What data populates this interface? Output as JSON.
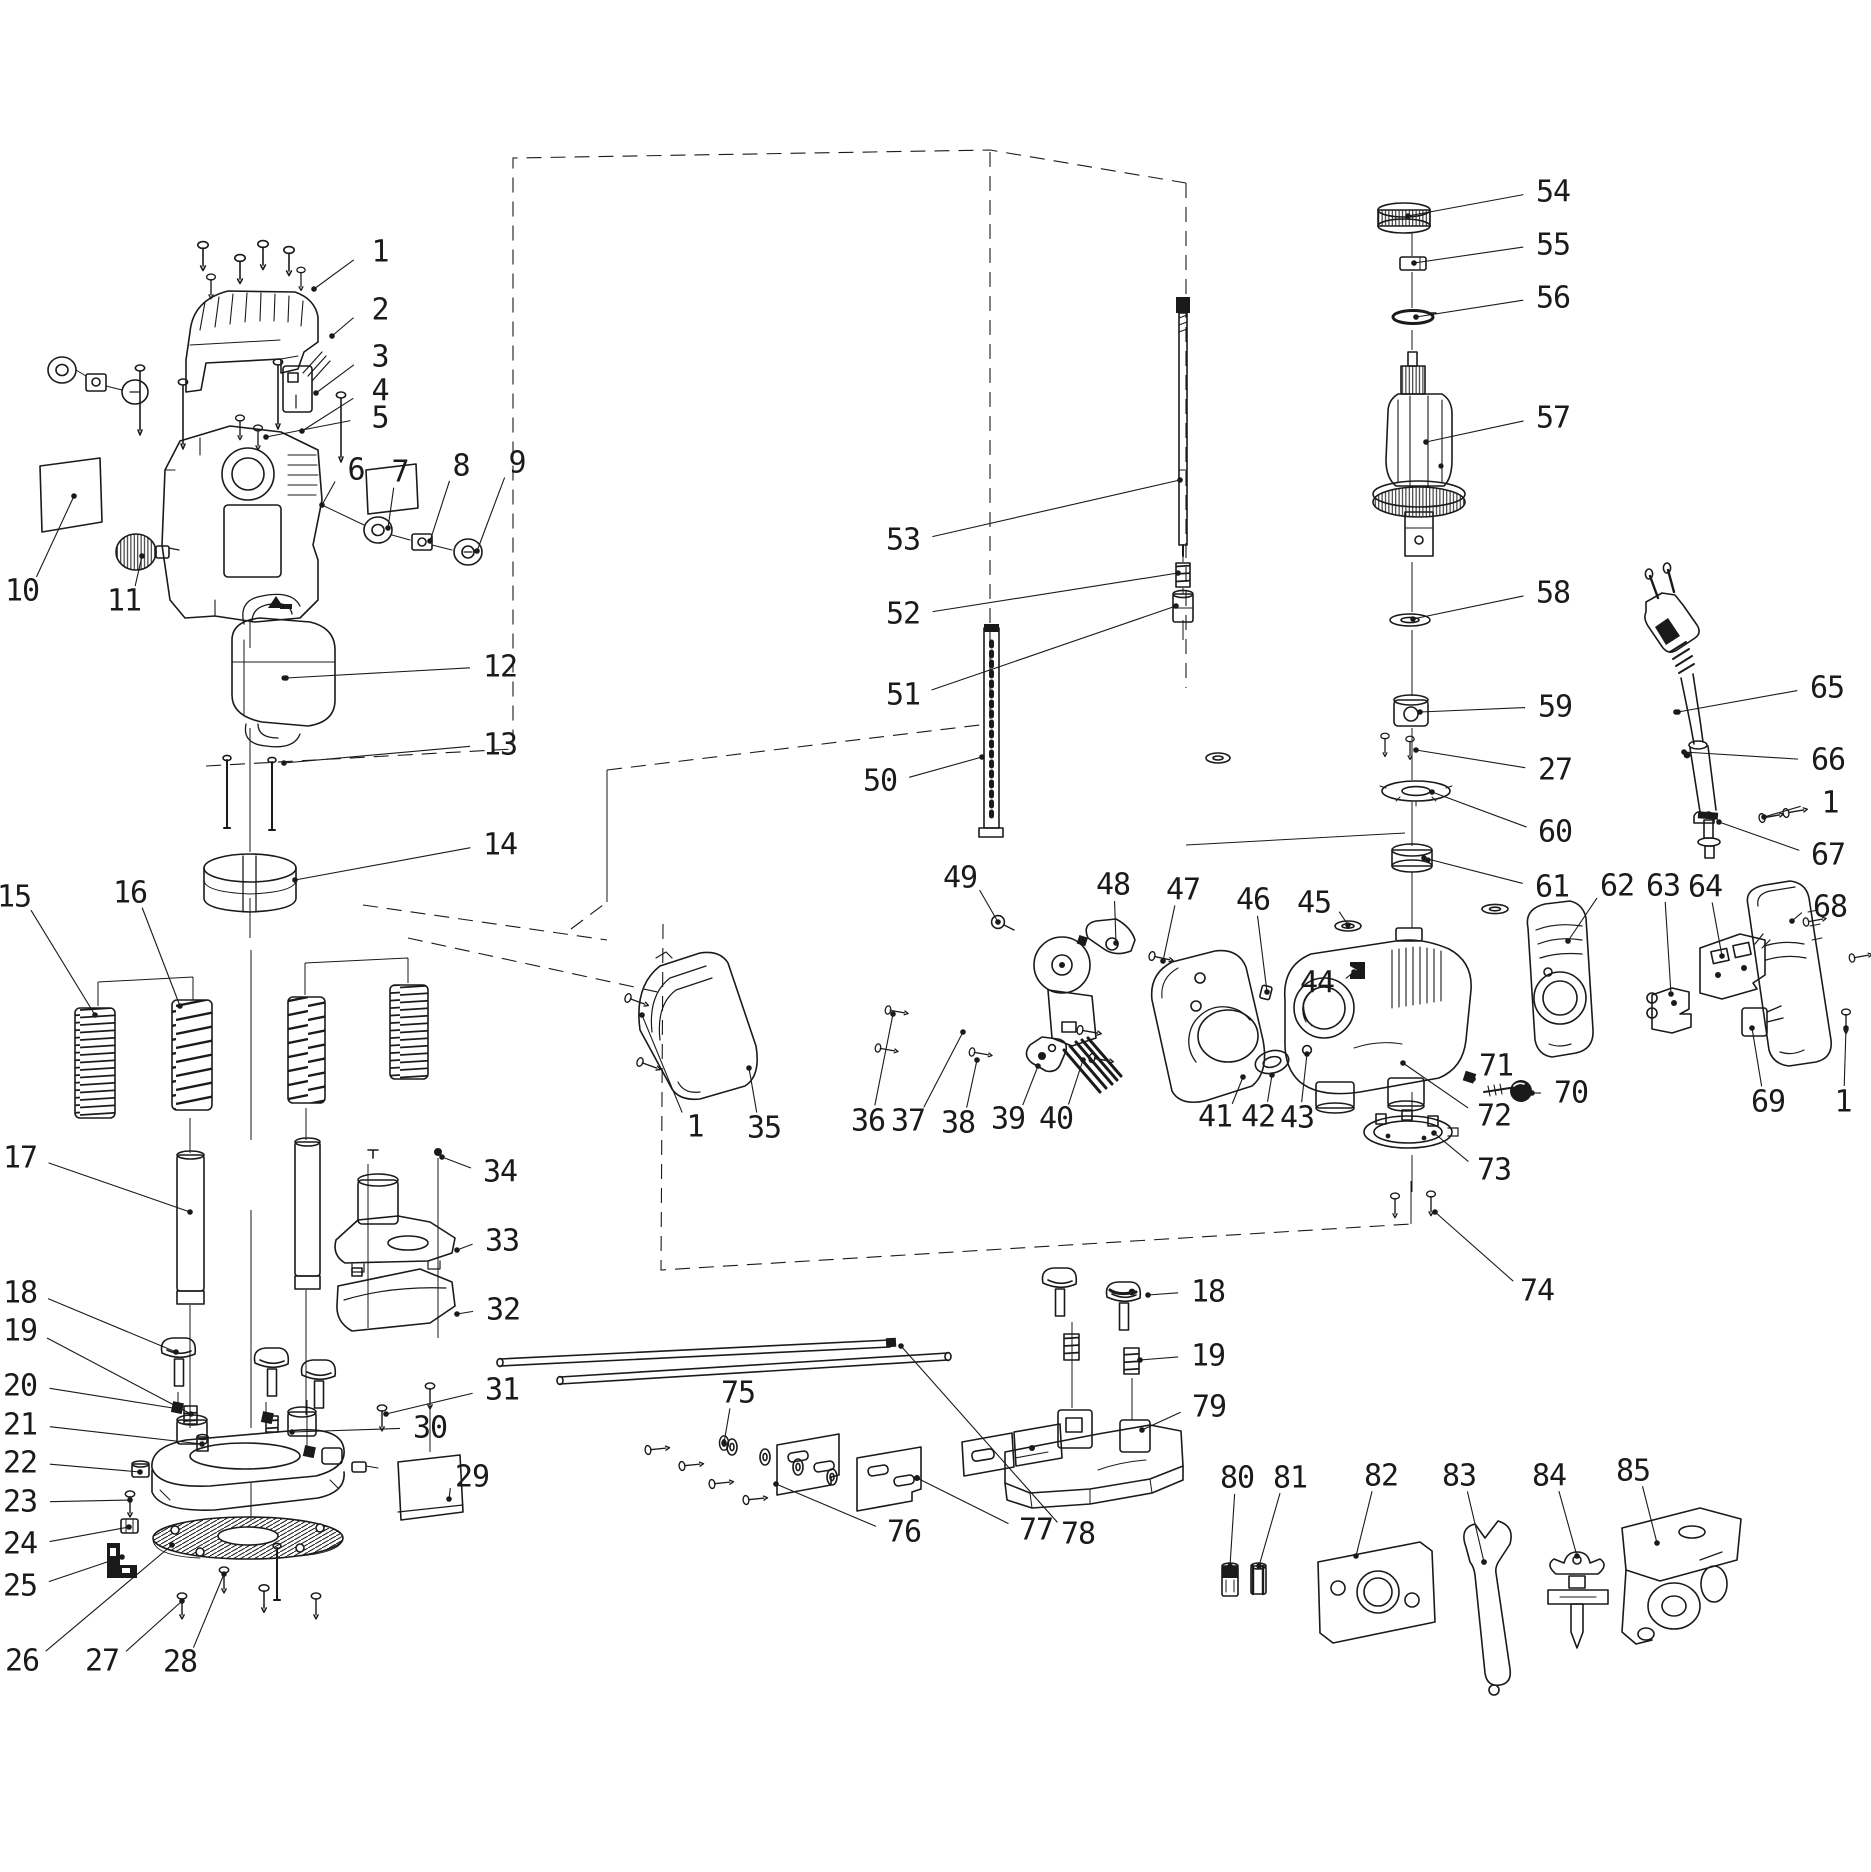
{
  "figure": {
    "width": 1871,
    "height": 1872,
    "background": "#ffffff",
    "ink": "#1a1a1a",
    "kind": "exploded-parts-diagram"
  },
  "callouts": [
    {
      "n": "1",
      "x": 380,
      "y": 252,
      "ex": 314,
      "ey": 289
    },
    {
      "n": "2",
      "x": 380,
      "y": 310,
      "ex": 332,
      "ey": 336
    },
    {
      "n": "3",
      "x": 380,
      "y": 357,
      "ex": 316,
      "ey": 393
    },
    {
      "n": "4",
      "x": 380,
      "y": 391,
      "ex": 302,
      "ey": 431
    },
    {
      "n": "5",
      "x": 380,
      "y": 418,
      "ex": 266,
      "ey": 437
    },
    {
      "n": "6",
      "x": 356,
      "y": 470,
      "ex": 322,
      "ey": 505
    },
    {
      "n": "7",
      "x": 400,
      "y": 472,
      "ex": 388,
      "ey": 528
    },
    {
      "n": "8",
      "x": 461,
      "y": 466,
      "ex": 430,
      "ey": 541
    },
    {
      "n": "9",
      "x": 517,
      "y": 463,
      "ex": 477,
      "ey": 551
    },
    {
      "n": "10",
      "x": 22,
      "y": 591,
      "ex": 74,
      "ey": 496
    },
    {
      "n": "11",
      "x": 124,
      "y": 601,
      "ex": 142,
      "ey": 556
    },
    {
      "n": "12",
      "x": 500,
      "y": 667,
      "ex": 286,
      "ey": 678
    },
    {
      "n": "13",
      "x": 500,
      "y": 745,
      "ex": 284,
      "ey": 763
    },
    {
      "n": "14",
      "x": 500,
      "y": 845,
      "ex": 295,
      "ey": 880
    },
    {
      "n": "15",
      "x": 14,
      "y": 897,
      "ex": 95,
      "ey": 1015
    },
    {
      "n": "16",
      "x": 130,
      "y": 893,
      "ex": 180,
      "ey": 1006
    },
    {
      "n": "17",
      "x": 20,
      "y": 1158,
      "ex": 190,
      "ey": 1212
    },
    {
      "n": "18",
      "x": 20,
      "y": 1293,
      "ex": 176,
      "ey": 1352
    },
    {
      "n": "19",
      "x": 20,
      "y": 1331,
      "ex": 191,
      "ey": 1414
    },
    {
      "n": "20",
      "x": 20,
      "y": 1386,
      "ex": 179,
      "ey": 1409
    },
    {
      "n": "21",
      "x": 20,
      "y": 1425,
      "ex": 202,
      "ey": 1444
    },
    {
      "n": "22",
      "x": 20,
      "y": 1463,
      "ex": 140,
      "ey": 1472
    },
    {
      "n": "23",
      "x": 20,
      "y": 1502,
      "ex": 130,
      "ey": 1500
    },
    {
      "n": "24",
      "x": 20,
      "y": 1544,
      "ex": 129,
      "ey": 1527
    },
    {
      "n": "25",
      "x": 20,
      "y": 1586,
      "ex": 122,
      "ey": 1557
    },
    {
      "n": "26",
      "x": 22,
      "y": 1661,
      "ex": 172,
      "ey": 1545
    },
    {
      "n": "27",
      "x": 102,
      "y": 1661,
      "ex": 182,
      "ey": 1601
    },
    {
      "n": "28",
      "x": 180,
      "y": 1662,
      "ex": 224,
      "ey": 1574
    },
    {
      "n": "29",
      "x": 472,
      "y": 1477,
      "ex": 449,
      "ey": 1499
    },
    {
      "n": "30",
      "x": 430,
      "y": 1428,
      "ex": 292,
      "ey": 1432
    },
    {
      "n": "31",
      "x": 502,
      "y": 1390,
      "ex": 386,
      "ey": 1414
    },
    {
      "n": "32",
      "x": 503,
      "y": 1310,
      "ex": 457,
      "ey": 1314
    },
    {
      "n": "33",
      "x": 502,
      "y": 1241,
      "ex": 457,
      "ey": 1250
    },
    {
      "n": "34",
      "x": 500,
      "y": 1172,
      "ex": 442,
      "ey": 1157
    },
    {
      "n": "1",
      "x": 695,
      "y": 1127,
      "ex": 642,
      "ey": 1015
    },
    {
      "n": "35",
      "x": 764,
      "y": 1128,
      "ex": 749,
      "ey": 1068
    },
    {
      "n": "36",
      "x": 868,
      "y": 1121,
      "ex": 893,
      "ey": 1014
    },
    {
      "n": "37",
      "x": 908,
      "y": 1121,
      "ex": 963,
      "ey": 1032
    },
    {
      "n": "38",
      "x": 958,
      "y": 1123,
      "ex": 977,
      "ey": 1060
    },
    {
      "n": "39",
      "x": 1008,
      "y": 1119,
      "ex": 1038,
      "ey": 1066
    },
    {
      "n": "40",
      "x": 1056,
      "y": 1119,
      "ex": 1083,
      "ey": 1060
    },
    {
      "n": "41",
      "x": 1215,
      "y": 1117,
      "ex": 1243,
      "ey": 1077
    },
    {
      "n": "42",
      "x": 1258,
      "y": 1117,
      "ex": 1272,
      "ey": 1075
    },
    {
      "n": "43",
      "x": 1297,
      "y": 1118,
      "ex": 1307,
      "ey": 1054
    },
    {
      "n": "44",
      "x": 1317,
      "y": 983,
      "ex": 1354,
      "ey": 972
    },
    {
      "n": "45",
      "x": 1314,
      "y": 903,
      "ex": 1348,
      "ey": 925
    },
    {
      "n": "46",
      "x": 1253,
      "y": 900,
      "ex": 1267,
      "ey": 992
    },
    {
      "n": "47",
      "x": 1183,
      "y": 890,
      "ex": 1163,
      "ey": 961
    },
    {
      "n": "48",
      "x": 1113,
      "y": 885,
      "ex": 1116,
      "ey": 943
    },
    {
      "n": "49",
      "x": 960,
      "y": 878,
      "ex": 998,
      "ey": 922
    },
    {
      "n": "50",
      "x": 880,
      "y": 781,
      "ex": 982,
      "ey": 757
    },
    {
      "n": "51",
      "x": 903,
      "y": 695,
      "ex": 1176,
      "ey": 606
    },
    {
      "n": "52",
      "x": 903,
      "y": 614,
      "ex": 1178,
      "ey": 573
    },
    {
      "n": "53",
      "x": 903,
      "y": 540,
      "ex": 1180,
      "ey": 480
    },
    {
      "n": "54",
      "x": 1553,
      "y": 192,
      "ex": 1408,
      "ey": 216
    },
    {
      "n": "55",
      "x": 1553,
      "y": 245,
      "ex": 1414,
      "ey": 263
    },
    {
      "n": "56",
      "x": 1553,
      "y": 298,
      "ex": 1416,
      "ey": 317
    },
    {
      "n": "57",
      "x": 1553,
      "y": 418,
      "ex": 1426,
      "ey": 442
    },
    {
      "n": "58",
      "x": 1553,
      "y": 593,
      "ex": 1413,
      "ey": 619
    },
    {
      "n": "59",
      "x": 1555,
      "y": 707,
      "ex": 1420,
      "ey": 712
    },
    {
      "n": "27",
      "x": 1555,
      "y": 770,
      "ex": 1416,
      "ey": 750
    },
    {
      "n": "60",
      "x": 1555,
      "y": 832,
      "ex": 1432,
      "ey": 792
    },
    {
      "n": "61",
      "x": 1552,
      "y": 887,
      "ex": 1424,
      "ey": 858
    },
    {
      "n": "62",
      "x": 1617,
      "y": 886,
      "ex": 1568,
      "ey": 941
    },
    {
      "n": "63",
      "x": 1663,
      "y": 886,
      "ex": 1671,
      "ey": 994
    },
    {
      "n": "64",
      "x": 1705,
      "y": 887,
      "ex": 1722,
      "ey": 956
    },
    {
      "n": "65",
      "x": 1827,
      "y": 688,
      "ex": 1678,
      "ey": 712
    },
    {
      "n": "66",
      "x": 1828,
      "y": 760,
      "ex": 1684,
      "ey": 752
    },
    {
      "n": "1",
      "x": 1830,
      "y": 803,
      "ex": 1764,
      "ey": 817
    },
    {
      "n": "67",
      "x": 1828,
      "y": 855,
      "ex": 1719,
      "ey": 822
    },
    {
      "n": "68",
      "x": 1830,
      "y": 907,
      "ex": 1792,
      "ey": 921
    },
    {
      "n": "69",
      "x": 1768,
      "y": 1102,
      "ex": 1752,
      "ey": 1028
    },
    {
      "n": "1",
      "x": 1843,
      "y": 1102,
      "ex": 1846,
      "ey": 1028
    },
    {
      "n": "70",
      "x": 1571,
      "y": 1093,
      "ex": 1532,
      "ey": 1093
    },
    {
      "n": "71",
      "x": 1496,
      "y": 1066,
      "ex": 1473,
      "ey": 1079
    },
    {
      "n": "72",
      "x": 1494,
      "y": 1116,
      "ex": 1403,
      "ey": 1063
    },
    {
      "n": "73",
      "x": 1494,
      "y": 1170,
      "ex": 1434,
      "ey": 1133
    },
    {
      "n": "74",
      "x": 1537,
      "y": 1291,
      "ex": 1435,
      "ey": 1212
    },
    {
      "n": "18",
      "x": 1208,
      "y": 1292,
      "ex": 1148,
      "ey": 1295
    },
    {
      "n": "19",
      "x": 1208,
      "y": 1356,
      "ex": 1140,
      "ey": 1360
    },
    {
      "n": "79",
      "x": 1209,
      "y": 1407,
      "ex": 1142,
      "ey": 1430
    },
    {
      "n": "75",
      "x": 738,
      "y": 1393,
      "ex": 724,
      "ey": 1443
    },
    {
      "n": "76",
      "x": 904,
      "y": 1532,
      "ex": 776,
      "ey": 1484
    },
    {
      "n": "77",
      "x": 1036,
      "y": 1530,
      "ex": 917,
      "ey": 1478
    },
    {
      "n": "78",
      "x": 1078,
      "y": 1534,
      "ex": 901,
      "ey": 1346
    },
    {
      "n": "80",
      "x": 1237,
      "y": 1478,
      "ex": 1230,
      "ey": 1566
    },
    {
      "n": "81",
      "x": 1290,
      "y": 1478,
      "ex": 1259,
      "ey": 1566
    },
    {
      "n": "82",
      "x": 1381,
      "y": 1476,
      "ex": 1356,
      "ey": 1556
    },
    {
      "n": "83",
      "x": 1459,
      "y": 1476,
      "ex": 1484,
      "ey": 1562
    },
    {
      "n": "84",
      "x": 1549,
      "y": 1476,
      "ex": 1577,
      "ey": 1556
    },
    {
      "n": "85",
      "x": 1633,
      "y": 1471,
      "ex": 1657,
      "ey": 1543
    }
  ]
}
